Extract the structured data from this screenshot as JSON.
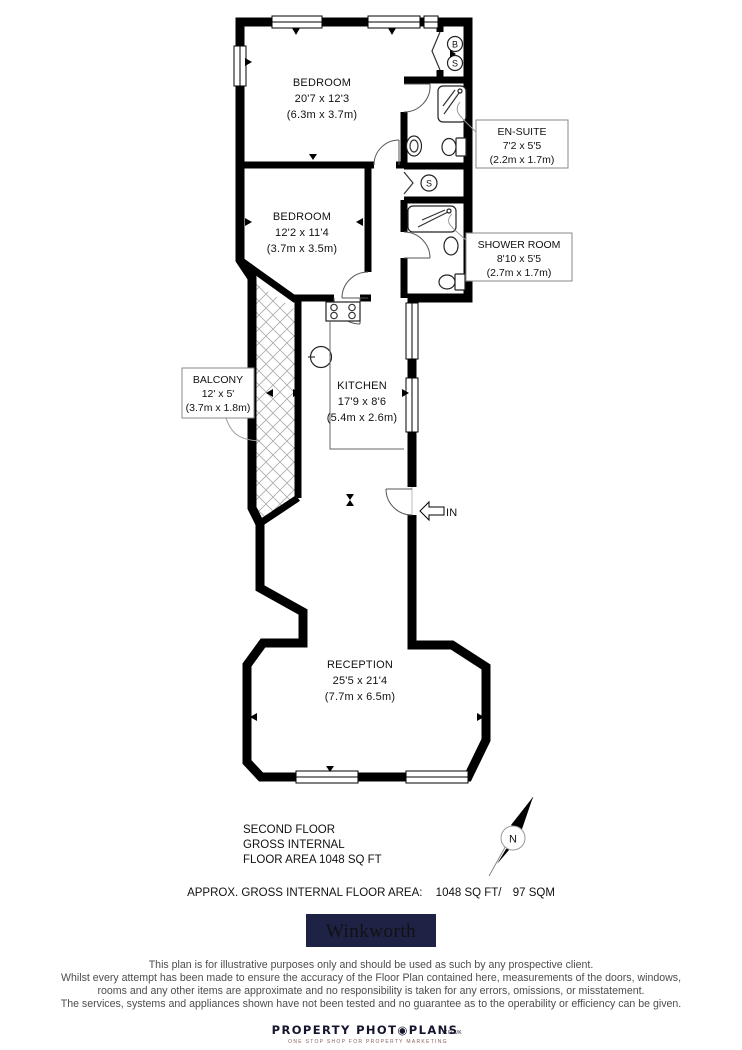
{
  "plan": {
    "rooms": {
      "bedroom1": {
        "name": "BEDROOM",
        "imperial": "20'7 x 12'3",
        "metric": "(6.3m x 3.7m)"
      },
      "bedroom2": {
        "name": "BEDROOM",
        "imperial": "12'2 x 11'4",
        "metric": "(3.7m x 3.5m)"
      },
      "ensuite": {
        "name": "EN-SUITE",
        "imperial": "7'2 x 5'5",
        "metric": "(2.2m x 1.7m)"
      },
      "shower_room": {
        "name": "SHOWER ROOM",
        "imperial": "8'10 x 5'5",
        "metric": "(2.7m x 1.7m)"
      },
      "balcony": {
        "name": "BALCONY",
        "imperial": "12' x 5'",
        "metric": "(3.7m x 1.8m)"
      },
      "kitchen": {
        "name": "KITCHEN",
        "imperial": "17'9 x 8'6",
        "metric": "(5.4m x 2.6m)"
      },
      "reception": {
        "name": "RECEPTION",
        "imperial": "25'5 x 21'4",
        "metric": "(7.7m x 6.5m)"
      }
    },
    "markers": {
      "entrance": "IN",
      "closet_boiler": "B",
      "closet_storage": "S",
      "storage": "S",
      "compass_north": "N"
    }
  },
  "summary": {
    "line1": "SECOND FLOOR",
    "line2": "GROSS INTERNAL",
    "line3": "FLOOR AREA 1048 SQ FT",
    "area_label": "APPROX. GROSS INTERNAL FLOOR AREA:",
    "area_ft": "1048 SQ FT/",
    "area_sqm": "97 SQM"
  },
  "brand": {
    "name": "Winkworth",
    "background": "#1e2244",
    "text_color": "#ffffff"
  },
  "disclaimer": {
    "lines": [
      "This plan is for illustrative purposes only and should be used as such by any prospective client.",
      "Whilst every attempt has been made to ensure the accuracy of the Floor Plan contained here, measurements of the doors, windows,",
      "rooms and any other items are approximate and no responsibility is taken for any errors, omissions, or misstatement.",
      "The services, systems and appliances shown have not been tested and no guarantee as to the operability or efficiency can be given."
    ]
  },
  "footer": {
    "logo_text": "PROPERTY PHOT◉PLANS",
    "logo_suffix": ".CO.UK",
    "tagline": "ONE STOP SHOP FOR PROPERTY MARKETING"
  }
}
